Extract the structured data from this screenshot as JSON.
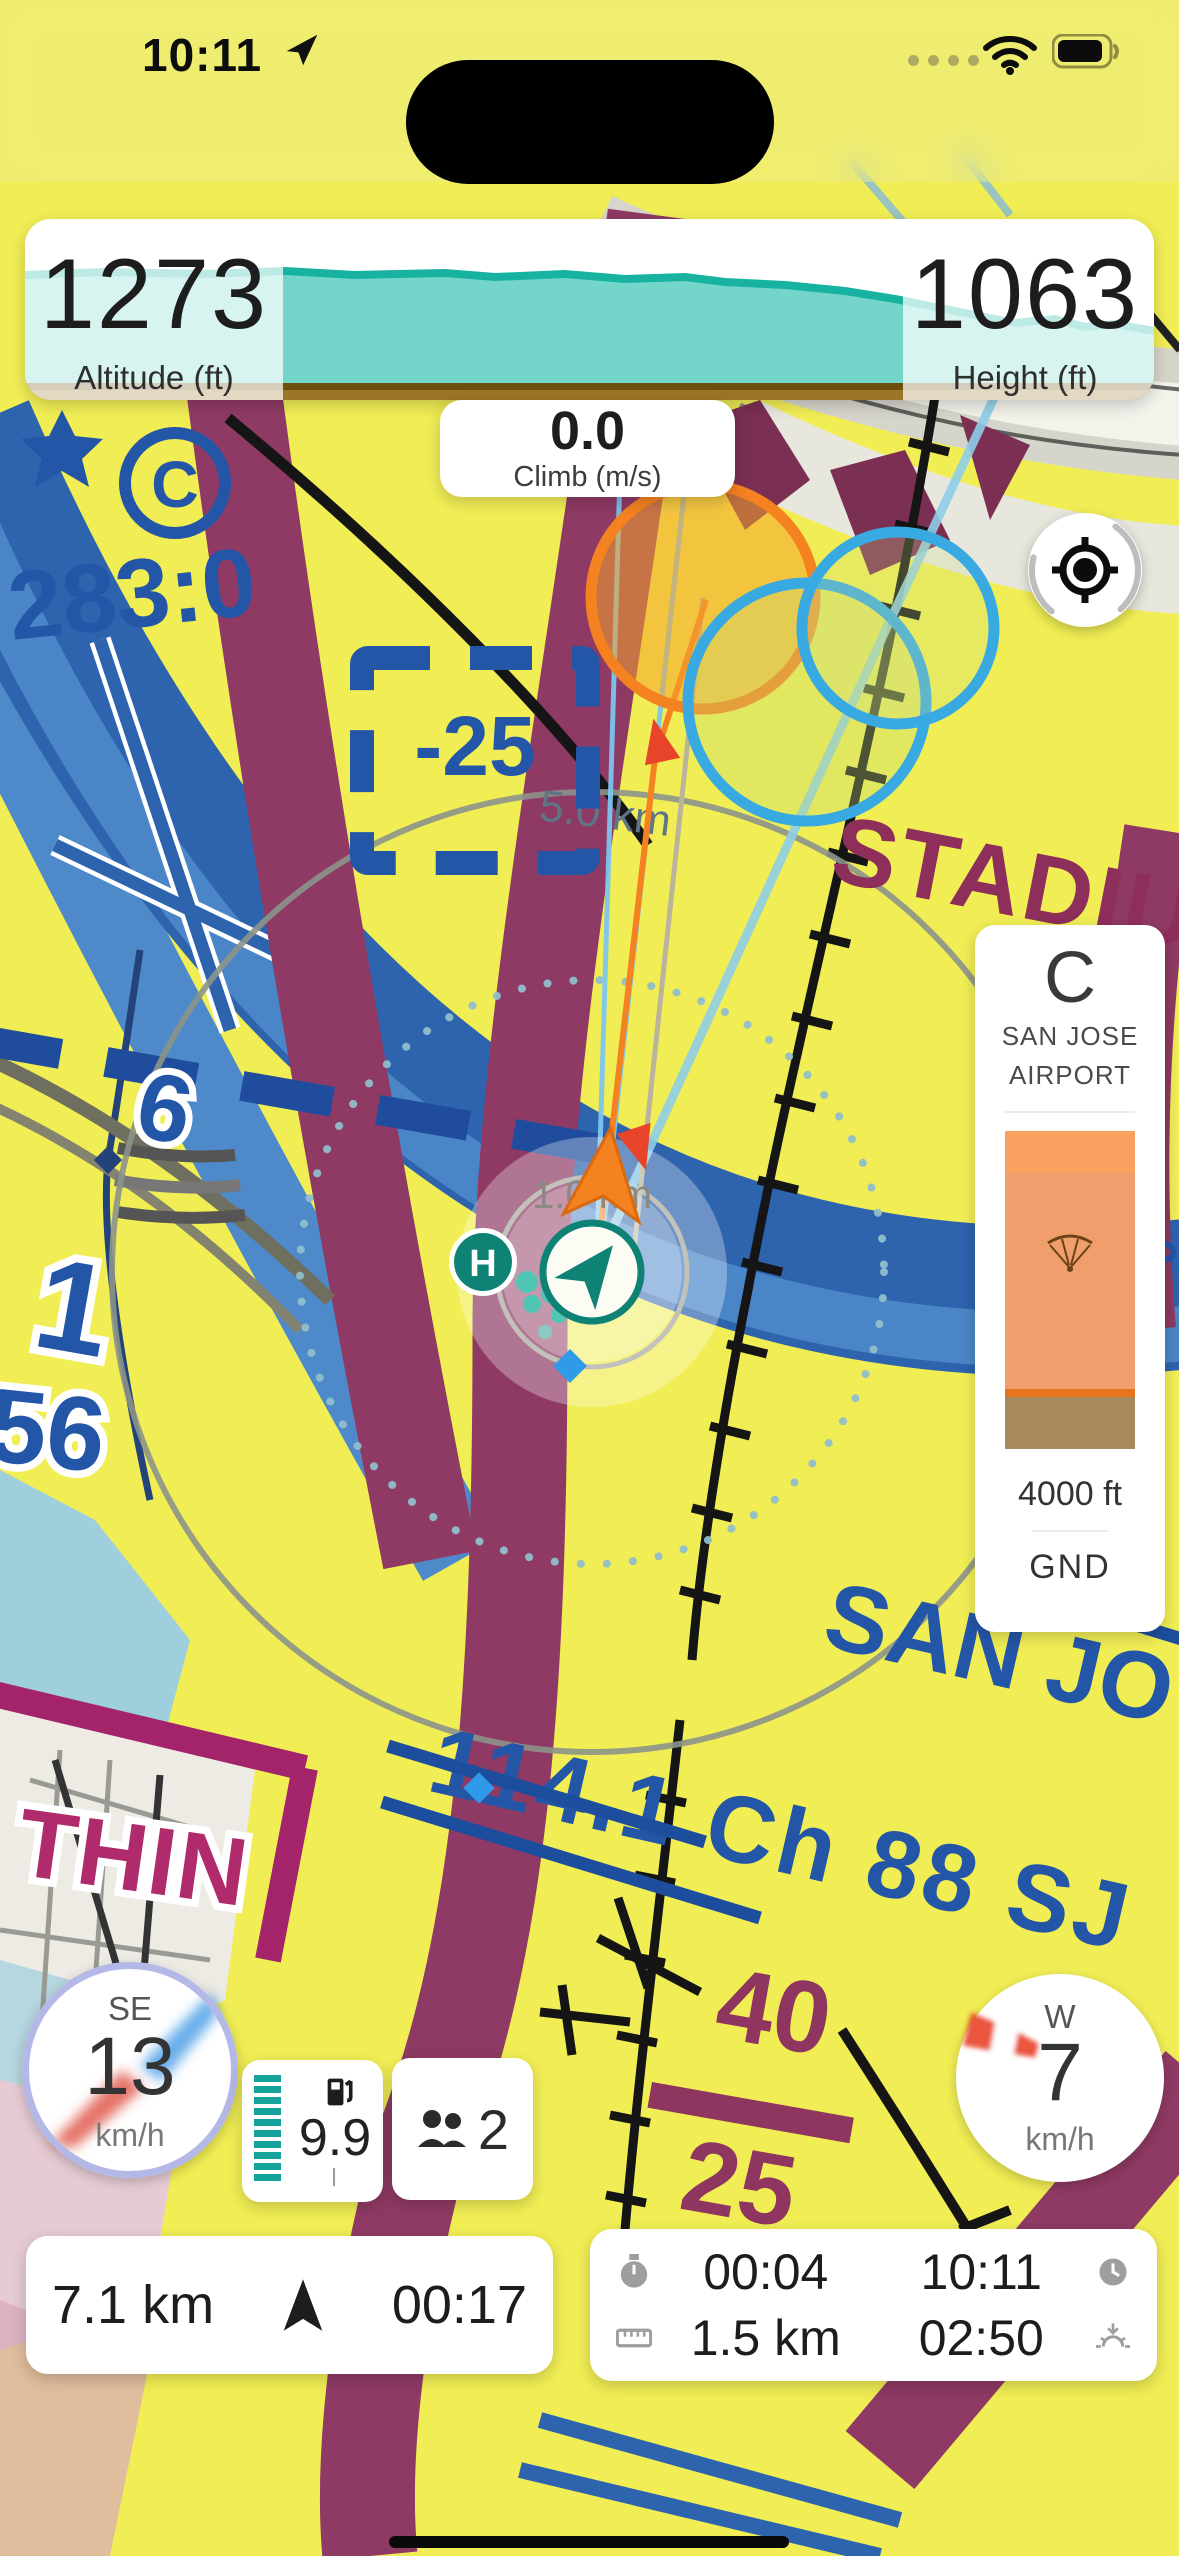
{
  "status_bar": {
    "time": "10:11"
  },
  "altimeter_panel": {
    "altitude_value": "1273",
    "altitude_label": "Altitude (ft)",
    "height_value": "1063",
    "height_label": "Height (ft)"
  },
  "climb_panel": {
    "value": "0.0",
    "label": "Climb (m/s)"
  },
  "airspace_panel": {
    "class": "C",
    "name_line1": "SAN JOSE",
    "name_line2": "AIRPORT",
    "ceiling": "4000 ft",
    "floor": "GND"
  },
  "wind_left": {
    "direction": "SE",
    "speed": "13",
    "unit": "km/h"
  },
  "wind_right": {
    "direction": "W",
    "speed": "7",
    "unit": "km/h"
  },
  "fuel_card": {
    "value": "9.9"
  },
  "passengers_card": {
    "count": "2"
  },
  "track_bar": {
    "distance": "7.1 km",
    "time": "00:17"
  },
  "stats_card": {
    "flight_time": "00:04",
    "clock_time": "10:11",
    "distance": "1.5 km",
    "sunset_countdown": "02:50"
  },
  "map": {
    "labels": {
      "freq": "283:0",
      "neg25": "-25",
      "stadium": "STADIUM",
      "ring_5km": "5.0 km",
      "ring_1km": "1.0 km",
      "t2": "T 2",
      "vo": "VO",
      "san_jo": "SAN JO",
      "vor_line": "114.1 Ch 88 SJ",
      "forty": "40",
      "twentyfive": "25",
      "thin": "THIN",
      "six": "6",
      "one": "1",
      "fiftysix": "56",
      "circle_c": "C",
      "helipad": "H"
    },
    "colors": {
      "chart_yellow": "#F1EE55",
      "chart_blue": "#2E63AE",
      "chart_maroon": "#8F3A64",
      "accent_teal": "#0F8276",
      "track_orange": "#F58220",
      "cyan_circle": "#39A9E2",
      "terrain_teal": "#74D6CA",
      "ground_brown": "#9C7526",
      "airspace_orange": "#EF9E6C"
    }
  }
}
